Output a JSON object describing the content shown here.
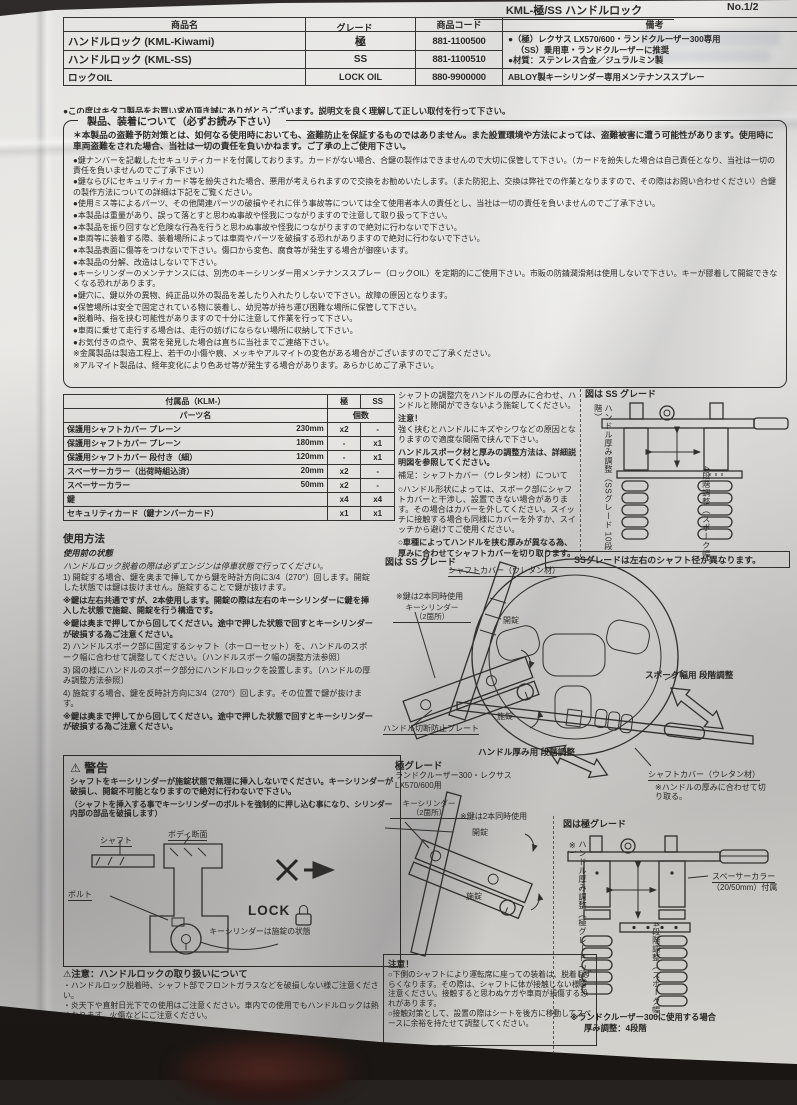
{
  "page": {
    "header_title": "KML-極/SS ハンドルロック",
    "page_no": "No.1/2"
  },
  "product_table": {
    "col_name": "商品名",
    "col_grade": "グレード",
    "col_code": "商品コード",
    "col_remarks": "備考",
    "rows": [
      {
        "name": "ハンドルロック (KML-Kiwami)",
        "grade": "極",
        "code": "881-1100500"
      },
      {
        "name": "ハンドルロック (KML-SS)",
        "grade": "SS",
        "code": "881-1100510"
      },
      {
        "name": "ロックOIL",
        "grade": "LOCK OIL",
        "code": "880-9900000"
      }
    ],
    "remarks_line1": "●（極）レクサス LX570/600・ランドクルーザー300専用",
    "remarks_line2": "（SS）乗用車・ランドクルーザーに推奨",
    "remarks_line3": "●材質：ステンレス合金／ジュラルミン製",
    "remarks_row3": "ABLOY製キーシリンダー専用メンテナンススプレー"
  },
  "greeting": "●この度はキタコ製品をお買い求め頂き誠にありがとうございます。説明文を良く理解して正しい取付を行って下さい。",
  "notice_box": {
    "title": "製品、装着について（必ずお読み下さい）",
    "items": [
      {
        "t": "＊本製品の盗難予防対策とは、如何なる使用時においても、盗難防止を保証するものではありません。また設置環境や方法によっては、盗難被害に遭う可能性があります。使用時に車両盗難をされた場合、当社は一切の責任を負いかねます。ご了承の上ご使用下さい。",
        "b": true
      },
      {
        "t": "●鍵ナンバーを記載したセキュリティカードを付属しております。カードがない場合、合鍵の製作はできませんので大切に保管して下さい。（カードを紛失した場合は自己責任となり、当社は一切の責任を負いませんのでご了承下さい）"
      },
      {
        "t": "●鍵ならびにセキュリティカード等を紛失された場合、悪用が考えられますので交換をお勧めいたします。（また防犯上、交換は弊社での作業となりますので、その際はお問い合わせください）合鍵の製作方法についての詳細は下記をご覧ください。"
      },
      {
        "t": "●使用ミス等によるパーツ、その他関連パーツの破損やそれに伴う事故等については全て使用者本人の責任とし、当社は一切の責任を負いませんのでご了承下さい。"
      },
      {
        "t": "●本製品は重量があり、誤って落とすと思わぬ事故や怪我につながりますので注意して取り扱って下さい。"
      },
      {
        "t": "●本製品を振り回すなど危険な行為を行うと思わぬ事故や怪我につながりますので絶対に行わないで下さい。"
      },
      {
        "t": "●車両等に装着する際、装着場所によっては車両やパーツを破損する恐れがありますので絶対に行わないで下さい。"
      },
      {
        "t": "●本製品表面に傷等をつけないで下さい。傷口から変色、腐食等が発生する場合が御座います。"
      },
      {
        "t": "●本製品の分解、改造はしないで下さい。"
      },
      {
        "t": "●キーシリンダーのメンテナンスには、別売のキーシリンダー用メンテナンススプレー（ロックOIL）を定期的にご使用下さい。市販の防錆潤滑剤は使用しないで下さい。キーが膠着して開錠できなくなる恐れがあります。"
      },
      {
        "t": "●鍵穴に、鍵以外の異物、純正品以外の製品を差したり入れたりしないで下さい。故障の原因となります。"
      },
      {
        "t": "●保管場所は安全で固定されている物に装着し、幼児等が持ち運び困難な場所に保管して下さい。"
      },
      {
        "t": "●脱着時、指を挟む可能性がありますので十分に注意して作業を行って下さい。"
      },
      {
        "t": "●車両に乗せて走行する場合は、走行の妨げにならない場所に収納して下さい。"
      },
      {
        "t": "●お気付きの点や、異常を発見した場合は直ちに当社までご連絡下さい。"
      },
      {
        "t": "※金属製品は製造工程上、若干の小傷や痕、メッキやアルマイトの変色がある場合がございますのでご了承ください。"
      },
      {
        "t": "※アルマイト製品は、経年変化により色あせ等が発生する場合があります。あらかじめご了承下さい。"
      }
    ]
  },
  "parts_table": {
    "title": "付属品（KLM-）",
    "col_parts": "パーツ名",
    "col_qty": "個数",
    "col_kiwami": "極",
    "col_ss": "SS",
    "rows": [
      {
        "name": "保護用シャフトカバー プレーン",
        "size": "230mm",
        "k": "x2",
        "s": "-"
      },
      {
        "name": "保護用シャフトカバー プレーン",
        "size": "180mm",
        "k": "-",
        "s": "x1"
      },
      {
        "name": "保護用シャフトカバー 段付き（細）",
        "size": "120mm",
        "k": "-",
        "s": "x1"
      },
      {
        "name": "スペーサーカラー（出荷時組込済）",
        "size": "20mm",
        "k": "x2",
        "s": "-"
      },
      {
        "name": "スペーサーカラー",
        "size": "50mm",
        "k": "x2",
        "s": "-"
      },
      {
        "name": "鍵",
        "size": "",
        "k": "x4",
        "s": "x4"
      },
      {
        "name": "セキュリティカード（鍵ナンバーカード）",
        "size": "",
        "k": "x1",
        "s": "x1"
      }
    ]
  },
  "usage": {
    "title": "使用方法",
    "pre1": "使用前の状態",
    "pre2": "ハンドルロック脱着の際は必ずエンジンは停車状態で行ってください。",
    "steps": [
      {
        "t": "1) 開錠する場合、鍵を奥まで挿してから鍵を時計方向に3/4（270°）回します。開錠した状態では鍵は抜けません。施錠することで鍵が抜けます。"
      },
      {
        "t": "※鍵は左右共通ですが、2本使用します。開錠の際は左右のキーシリンダーに鍵を挿入した状態で施錠、開錠を行う構造です。",
        "b": true
      },
      {
        "t": "※鍵は奥まで押してから回してください。途中で押した状態で回すとキーシリンダーが破損する為ご注意ください。",
        "b": true
      },
      {
        "t": "2) ハンドルスポーク部に固定するシャフト（ホーローセット）を、ハンドルのスポーク幅に合わせて調整してください。〔ハンドルスポーク幅の調整方法参照〕"
      },
      {
        "t": "3) 図の様にハンドルのスポーク部分にハンドルロックを設置します。〔ハンドルの厚み調整方法参照〕"
      },
      {
        "t": "4) 施錠する場合、鍵を反時計方向に3/4（270°）回します。その位置で鍵が抜けます。"
      },
      {
        "t": "※鍵は奥まで押してから回してください。途中で押した状態で回すとキーシリンダーが破損する為ご注意ください。",
        "b": true
      }
    ]
  },
  "warning_box": {
    "mark": "⚠",
    "title": "警告",
    "p1": "シャフトをキーシリンダーが施錠状態で無理に挿入しないでください。キーシリンダーが破損し、開錠不可能となりますので絶対に行わないで下さい。",
    "p2": "（シャフトを挿入する事でキーシリンダーのボルトを強制的に押し込む事になり、シリンダー内部の部品を破損します）",
    "lbl_shaft": "シャフト",
    "lbl_body": "ボディ断面",
    "lbl_bolt": "ボルト",
    "lbl_lock": "LOCK",
    "lbl_state": "キーシリンダーは施錠の状態"
  },
  "caution_handling": {
    "mark": "⚠",
    "title": "注意：ハンドルロックの取り扱いについて",
    "items": [
      "・ハンドルロック脱着時、シャフト部でフロントガラスなどを破損しない様ご注意ください。",
      "・炎天下や直射日光下での使用はご注意ください。車内での使用でもハンドルロックは熱くなります。火傷などにご注意ください。"
    ]
  },
  "mid_notes": {
    "p1": "シャフトの調整穴をハンドルの厚みに合わせ、ハンドルと隙間ができないよう施錠してください。",
    "attn": "注意！",
    "p2": "強く挟むとハンドルにキズやシワなどの原因となりますので適度な間隔で挟んで下さい。",
    "p3": "ハンドルスポーク材と厚みの調整方法は、詳細説明図を参照してください。",
    "sup_title": "補足：シャフトカバー（ウレタン材）について",
    "sup1": "○ハンドル形状によっては、スポーク部にシャフトカバーと干渉し、設置できない場合があります。その場合はカバーを外してください。スイッチに接触する場合も同様にカバーを外すか、スイッチから避けてご使用ください。",
    "sup2": "○車種によってハンドルを挟む厚みが異なる為、厚みに合わせてシャフトカバーを切り取ります。"
  },
  "diagram_ss": {
    "fig_label": "図は SS グレード",
    "lbl_cover": "シャフトカバー（ウレタン材）",
    "lbl_two_keys": "※鍵は2本同時使用",
    "lbl_cyl1": "キーシリンダー",
    "lbl_cyl2": "（2箇所）",
    "lbl_unlock": "開錠",
    "lbl_lock": "施錠",
    "lbl_plate": "ハンドル切断防止プレート",
    "lbl_spoke_adj": "スポーク幅用 段階調整",
    "lbl_thick_adj": "ハンドル厚み用 段階調整",
    "lbl_cover2": "シャフトカバー（ウレタン材）",
    "lbl_cut": "※ハンドルの厚みに合わせて切り取る。"
  },
  "right_ss": {
    "fig_label": "図は SS グレード",
    "lbl_thickness": "ハンドル厚み調整",
    "lbl_thickness2": "（SSグレード 10段階）",
    "lbl_4step": "4段階調整",
    "lbl_4step2": "（スポーク幅）",
    "note_box": "SSグレードは左右のシャフト径が異なります。"
  },
  "kiwami": {
    "title": "極グレード",
    "subtitle": "ランドクルーザー300・レクサス LX570/600用",
    "lbl_cyl1": "キーシリンダー",
    "lbl_cyl2": "（2箇所）",
    "lbl_two_keys": "※鍵は2本同時使用",
    "lbl_unlock": "開錠",
    "lbl_lock": "施錠"
  },
  "right_kiwami": {
    "fig_label": "図は極グレード",
    "lbl_thickness": "ハンドル厚み調整",
    "lbl_thickness2": "（極グレード 7段階※）",
    "lbl_spacer": "スペーサーカラー",
    "lbl_spacer2": "（20/50mm）付属",
    "lbl_4step": "4段階調整",
    "lbl_4step2": "（スポーク幅）",
    "note1": "※ランドクルーザー300に使用する場合",
    "note2": "厚み調整：4段階"
  },
  "caution_box2": {
    "title": "注意！",
    "items": [
      "○下側のシャフトにより運転席に座っての装着は、脱着しずらくなります。その際は、シャフトに体が接触しない様ご注意ください。接触すると思わぬケガや車両が損傷する恐れがあります。",
      "○接触対策として、設置の際はシートを後方に移動してスペースに余裕を持たせて調整してください。"
    ]
  },
  "colors": {
    "paper": "#e9e8e5",
    "ink": "#24221f",
    "background": "#1a1714"
  }
}
